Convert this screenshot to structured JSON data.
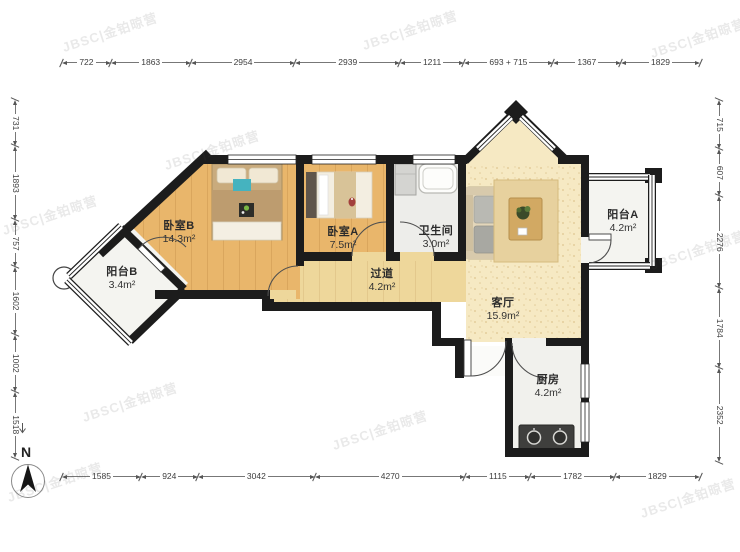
{
  "watermark": {
    "text": "JBSC|金铂晾营"
  },
  "compass": {
    "label": "N"
  },
  "rooms": {
    "bedroom_b": {
      "name": "卧室B",
      "area": "14.3m²"
    },
    "bedroom_a": {
      "name": "卧室A",
      "area": "7.5m²"
    },
    "bathroom": {
      "name": "卫生间",
      "area": "3.0m²"
    },
    "hallway": {
      "name": "过道",
      "area": "4.2m²"
    },
    "living_room": {
      "name": "客厅",
      "area": "15.9m²"
    },
    "kitchen": {
      "name": "厨房",
      "area": "4.2m²"
    },
    "balcony_a": {
      "name": "阳台A",
      "area": "4.2m²"
    },
    "balcony_b": {
      "name": "阳台B",
      "area": "3.4m²"
    }
  },
  "dimensions": {
    "top": {
      "segments": [
        {
          "label": "722",
          "mm": 722
        },
        {
          "label": "1863",
          "mm": 1863
        },
        {
          "label": "2954",
          "mm": 2954
        },
        {
          "label": "2939",
          "mm": 2939
        },
        {
          "label": "1211",
          "mm": 1211
        },
        {
          "label": "693 + 715",
          "mm": 1408
        },
        {
          "label": "1367",
          "mm": 1367
        },
        {
          "label": "1829",
          "mm": 1829
        }
      ]
    },
    "bottom": {
      "segments": [
        {
          "label": "1585",
          "mm": 1585
        },
        {
          "label": "924",
          "mm": 924
        },
        {
          "label": "3042",
          "mm": 3042
        },
        {
          "label": "4270",
          "mm": 4270
        },
        {
          "label": "1115",
          "mm": 1115
        },
        {
          "label": "1782",
          "mm": 1782
        },
        {
          "label": "1829",
          "mm": 1829
        }
      ]
    },
    "left": {
      "segments": [
        {
          "label": "731",
          "mm": 731
        },
        {
          "label": "1893",
          "mm": 1893
        },
        {
          "label": "757",
          "mm": 757
        },
        {
          "label": "1602",
          "mm": 1602
        },
        {
          "label": "1002",
          "mm": 1002
        },
        {
          "label": "1518",
          "mm": 1518
        }
      ]
    },
    "right": {
      "segments": [
        {
          "label": "715",
          "mm": 715
        },
        {
          "label": "607",
          "mm": 607
        },
        {
          "label": "2276",
          "mm": 2276
        },
        {
          "label": "1784",
          "mm": 1784
        },
        {
          "label": "2352",
          "mm": 2352
        }
      ]
    }
  },
  "colors": {
    "wall": "#1c1c1c",
    "wood_floor": "#e9b66b",
    "living_floor": "#f6e9c3",
    "tile_floor": "#f1f1ed",
    "hall_floor": "#eed79b",
    "accent_teal": "#45b3bf"
  }
}
